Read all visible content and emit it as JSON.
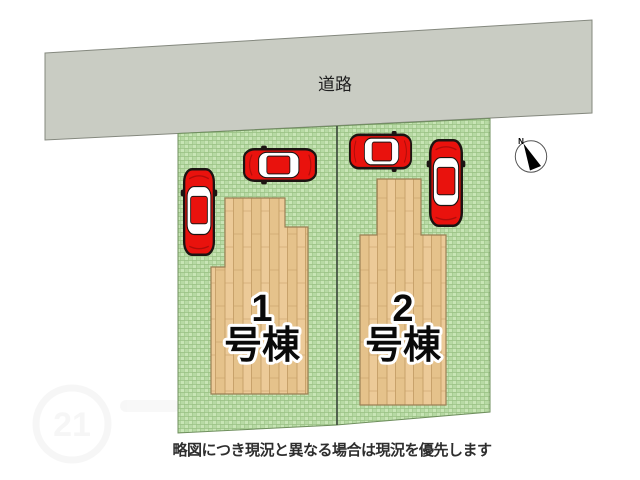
{
  "title": "site-plan",
  "road": {
    "label": "道路"
  },
  "lots": [
    {
      "name": "lot-1",
      "building": {
        "number": "1",
        "suffix": "号棟"
      },
      "cars_parked": 2
    },
    {
      "name": "lot-2",
      "building": {
        "number": "2",
        "suffix": "号棟"
      },
      "cars_parked": 2
    }
  ],
  "caption": {
    "text": "略図につき現況と異なる場合は現況を優先します"
  },
  "compass": {
    "north_label": "N"
  },
  "watermark": {
    "number": "21"
  },
  "colors": {
    "road_fill": "#c9ccc3",
    "road_edge": "#84887e",
    "grass_base": "#b7daa4",
    "grass_light": "#c8e5b6",
    "grass_line": "#98c083",
    "lot_edge": "#6f8f5e",
    "divider": "#3a453a",
    "wood_base": "#ecca98",
    "wood_alt": "#e5c28b",
    "wood_seam": "#c59e66",
    "building_edge": "#9b8055",
    "car_red": "#e9120d",
    "car_outline": "#1c1412",
    "car_glass": "#ffffff",
    "label_text": "#0a0a0a",
    "label_halo": "#ffffff",
    "caption_text": "#2e2e2e"
  }
}
